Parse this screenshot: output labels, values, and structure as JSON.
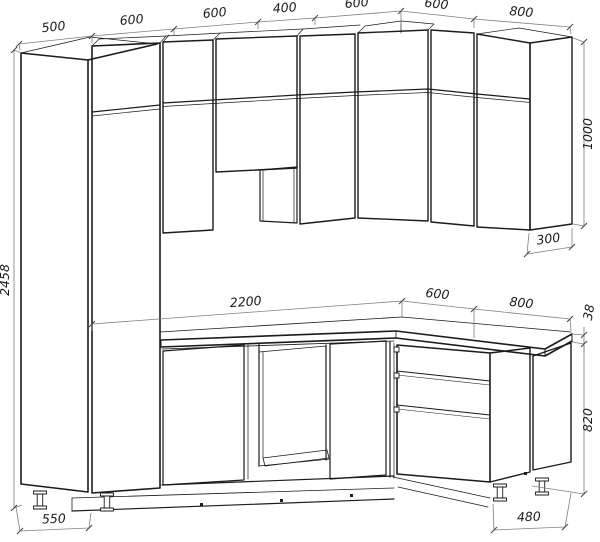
{
  "colors": {
    "line": "#1b1b1b",
    "dimension_line": "#7e7e7e",
    "label_text": "#1c1c1c",
    "background": "#ffffff"
  },
  "dimensions": {
    "top_run": [
      "500",
      "600",
      "600",
      "400",
      "600",
      "600",
      "800"
    ],
    "tall_cabinet_height": "2458",
    "wall_cabinet_height": "1000",
    "wall_cabinet_depth": "300",
    "worktop_run": [
      "2200",
      "600",
      "800"
    ],
    "worktop_thickness": "38",
    "base_cabinet_height": "820",
    "base_depth_left": "550",
    "base_depth_right": "480"
  }
}
